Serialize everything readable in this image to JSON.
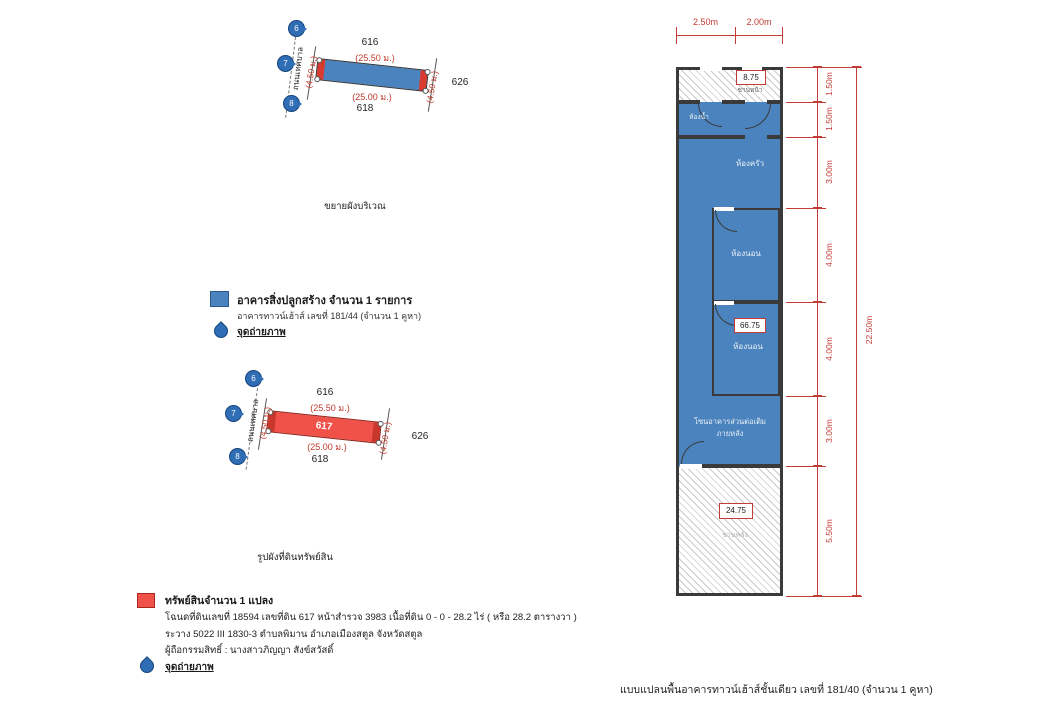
{
  "colors": {
    "building_blue": "#4a83bd",
    "property_red": "#f0524a",
    "dimension_red": "#c23b35",
    "wall": "#3a3a3a",
    "pin_blue": "#2f6db5"
  },
  "enlarged_plan": {
    "title": "ขยายผังบริเวณ",
    "road_label": "ถนนเทศบาล",
    "parcel_above": "616",
    "parcel_below": "618",
    "parcel_right": "626",
    "length_top": "(25.50 ม.)",
    "length_bottom": "(25.00 ม.)",
    "side_left": "(4.50 ม.)",
    "side_right": "(4.50 ม.)",
    "pins": [
      "6",
      "7",
      "8"
    ]
  },
  "building_legend": {
    "line1": "อาคารสิ่งปลูกสร้าง จำนวน 1 รายการ",
    "line2": "อาคารทาวน์เฮ้าส์ เลขที่ 181/44 (จำนวน 1 คูหา)",
    "photo_point": "จุดถ่ายภาพ"
  },
  "land_plan": {
    "title": "รูปผังที่ดินทรัพย์สิน",
    "road_label": "ถนนเทศบาล",
    "parcel_no": "617",
    "parcel_above": "616",
    "parcel_below": "618",
    "parcel_right": "626",
    "length_top": "(25.50 ม.)",
    "length_bottom": "(25.00 ม.)",
    "side_left": "(4.50 ม.)",
    "side_right": "(4.50 ม.)",
    "pins": [
      "6",
      "7",
      "8"
    ]
  },
  "property": {
    "heading": "ทรัพย์สินจำนวน 1 แปลง",
    "deed_line": "โฉนดที่ดินเลขที่ 18594 เลขที่ดิน 617 หน้าสำรวจ 3983  เนื้อที่ดิน 0 - 0 - 28.2 ไร่ ( หรือ 28.2 ตารางวา )",
    "sheet_line": "ระวาง 5022 III 1830-3  ตำบลพิมาน อำเภอเมืองสตูล  จังหวัดสตูล",
    "owner_line": "ผู้ถือกรรมสิทธิ์ : นางสาวภิญญา สังข์สวัสดิ์",
    "photo_point": "จุดถ่ายภาพ"
  },
  "floorplan": {
    "caption": "แบบแปลนพื้นอาคารทาวน์เฮ้าส์ชั้นเดียว เลขที่ 181/40 (จำนวน 1 คูหา)",
    "top_dims": [
      "2.50m",
      "2.00m"
    ],
    "right_dims": [
      "1.50m",
      "1.50m",
      "3.00m",
      "4.00m",
      "4.00m",
      "3.00m",
      "5.50m"
    ],
    "overall_dim": "22.50m",
    "areas": {
      "front": "8.75",
      "front_label": "ชานหน้า",
      "main": "66.75",
      "back": "24.75",
      "back_label": "ชานหลัง"
    },
    "rooms": {
      "bathroom": "ห้องน้ำ",
      "kitchen": "ห้องครัว",
      "bedroom1": "ห้องนอน",
      "bedroom2": "ห้องนอน",
      "extension_line1": "โซนอาคารส่วนต่อเติม",
      "extension_line2": "ภายหลัง"
    }
  }
}
